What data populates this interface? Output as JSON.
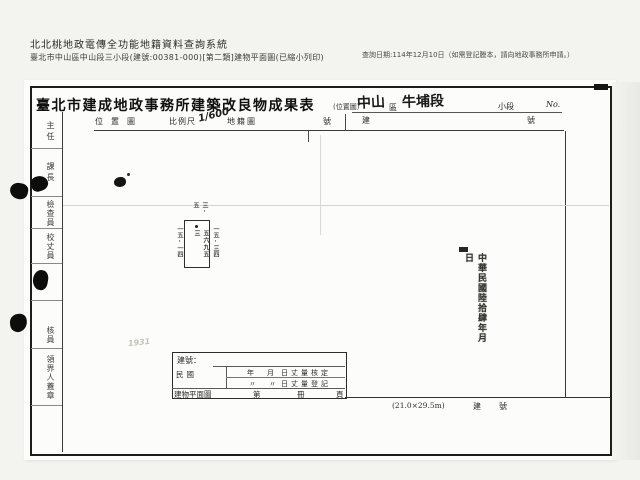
{
  "header": {
    "system_title": "北北桃地政電傳全功能地籍資料查詢系統",
    "document_line": "臺北市中山區中山段三小段(建號:00381-000)[第二類]建物平面圖(已縮小列印)",
    "query_date": "查詢日期:114年12月10日（如需登記謄本，請向地政事務所申請。）"
  },
  "form": {
    "title": "臺北市建成地政事務所建築改良物成果表",
    "position_map_note": "(位置圖)",
    "district_value": "中山",
    "district_suffix": "區",
    "section_value": "牛埔段",
    "subsection_label": "小段",
    "no_label": "No.",
    "band": {
      "location_map": "位置圖",
      "scale_label": "比例尺",
      "scale_value": "1/600",
      "cadastral_map": "地籍圖",
      "no_char_left": "號",
      "building_char": "建",
      "no_char_right": "號"
    },
    "left_strip": {
      "s1": "主任",
      "s2": "課長",
      "s3": "檢查員",
      "s4": "校丈員",
      "s6": "核員",
      "s7": "領界人蓋章"
    },
    "plan": {
      "top_dim": "三·五",
      "left_dim": "一五·一四",
      "right_dim": "一五·三四",
      "inner_text": "五六九五三"
    },
    "date_stamp": "中華民國陸拾肆年月日",
    "bottom_box": {
      "row1": "建號：",
      "era": "民國",
      "year": "年",
      "month": "月",
      "ditto": "〃",
      "line1_tail": "日丈量核定",
      "line2_tail": "日丈量登記",
      "plan_label": "建物平面圖",
      "ordinal": "第",
      "book": "冊",
      "page": "頁"
    },
    "footer": {
      "paper_size": "(21.0×29.5m)",
      "building_no": "建號"
    },
    "pencil_note": "1931"
  }
}
